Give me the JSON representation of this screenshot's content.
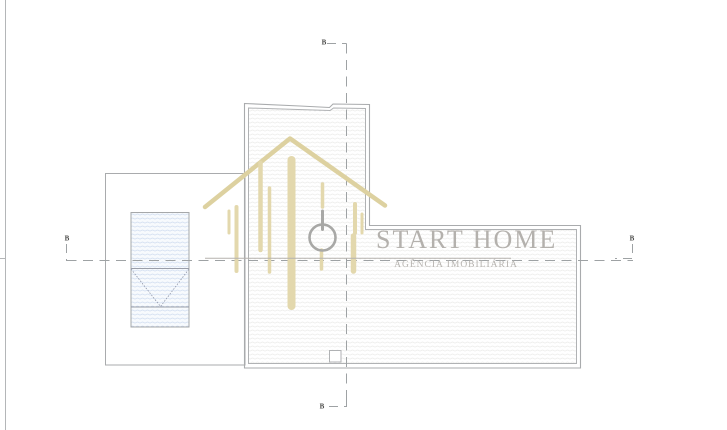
{
  "watermark": {
    "title": "START HOME",
    "subtitle": "AGÊNCIA IMOBILIÁRIA"
  },
  "section_labels": {
    "top": "B",
    "bottom": "B",
    "left": "B",
    "right": "B"
  },
  "colors": {
    "watermark_gold": "#e3d8ad",
    "watermark_gray": "#b4b1ad",
    "outline_gray": "#a9abad",
    "dash_gray": "#9ea2a4",
    "pool_hatch_blue": "#ccd9ee",
    "roof_hatch_gray": "#e9e9e7"
  },
  "icons": {
    "house": "house-watermark-icon",
    "power": "power-icon"
  }
}
